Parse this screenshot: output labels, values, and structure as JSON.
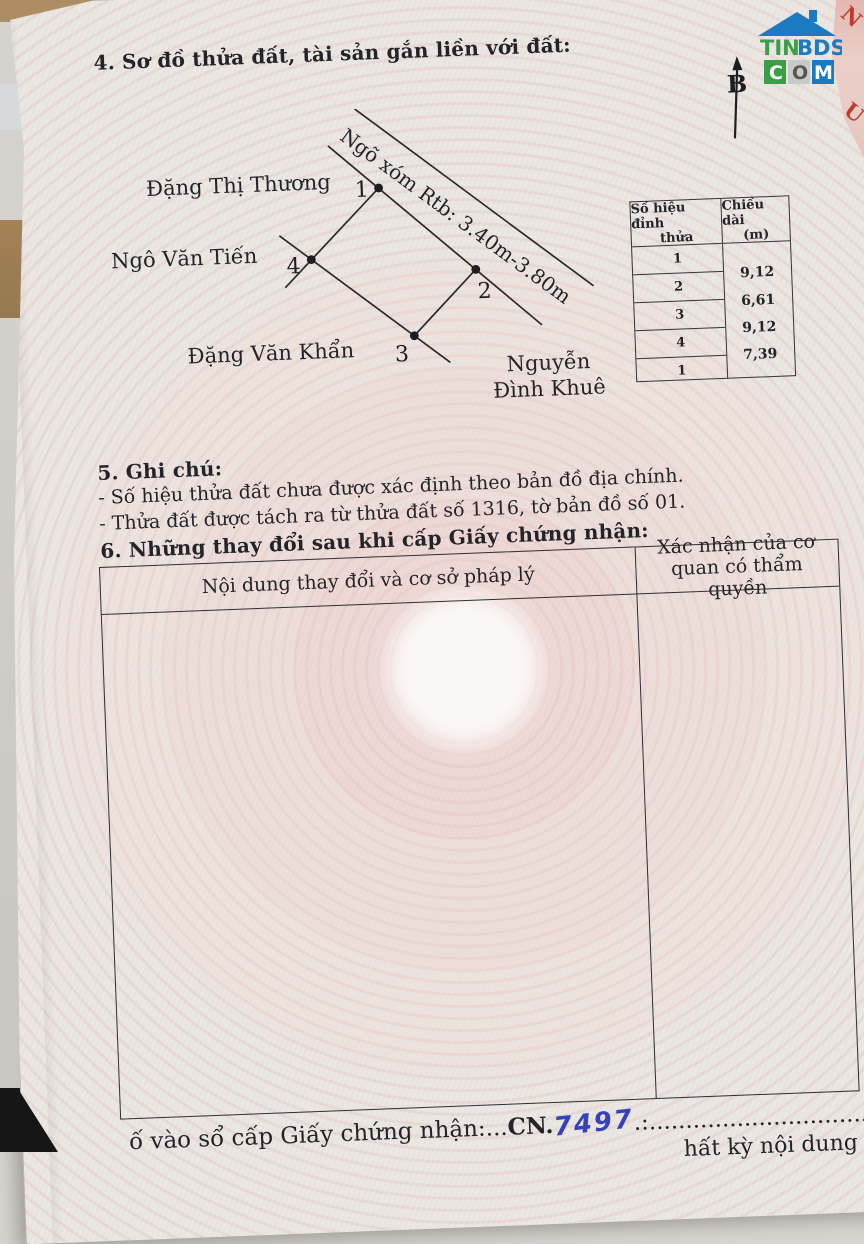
{
  "page": {
    "section4_title": "4. Sơ đồ thửa đất, tài sản gắn liền với đất:",
    "north_label": "B"
  },
  "diagram": {
    "road_label": "Ngõ xóm Rtb: 3.40m-3.80m",
    "neighbor_top": "Đặng Thị Thương",
    "neighbor_left": "Ngô Văn Tiến",
    "neighbor_bottom": "Đặng Văn Khẩn",
    "neighbor_right_line1": "Nguyễn",
    "neighbor_right_line2": "Đình Khuê",
    "vertices": [
      "1",
      "2",
      "3",
      "4"
    ]
  },
  "vertex_table": {
    "col1_header_line1": "Số hiệu đỉnh",
    "col1_header_line2": "thửa",
    "col2_header_line1": "Chiều dài",
    "col2_header_line2": "(m)",
    "vertex_ids": [
      "1",
      "2",
      "3",
      "4",
      "1"
    ],
    "lengths": [
      "9,12",
      "6,61",
      "9,12",
      "7,39"
    ]
  },
  "section5": {
    "title": "5. Ghi chú:",
    "note1": "- Số hiệu thửa đất chưa được xác định theo bản đồ địa chính.",
    "note2": "- Thửa đất được tách ra từ thửa đất số 1316, tờ bản đồ số 01."
  },
  "section6": {
    "title": "6. Những thay đổi sau khi cấp Giấy chứng nhận:",
    "col_left_header": "Nội dung thay đổi và cơ sở pháp lý",
    "col_right_header": "Xác nhận của cơ quan có thẩm quyền"
  },
  "footer": {
    "registry_fragment": "ố vào sổ cấp Giấy chứng nhận:...",
    "cn_prefix": "CN.",
    "cn_number": "7497",
    "dots": ".:..............................",
    "right_fragment": "hất kỳ nội dung nào"
  },
  "watermark": {
    "name_green": "TIN",
    "name_blue": "BDS",
    "box1": "C",
    "box2": "O",
    "box3": "M"
  },
  "side_paper": {
    "letter1": "N",
    "letter2": "U"
  },
  "colors": {
    "handwriting_blue": "#3642b8",
    "logo_green": "#3a9e49",
    "logo_blue": "#1b7ac2",
    "red_letters": "#c23a2e",
    "ink": "#23232a",
    "guilloche_pink": "#f0c9c7"
  }
}
